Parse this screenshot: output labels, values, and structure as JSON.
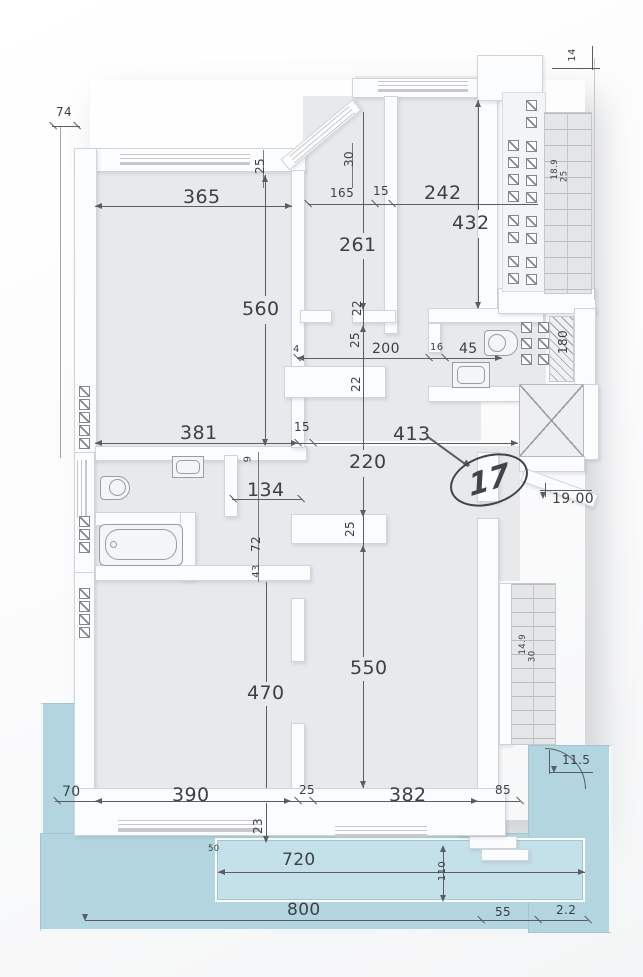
{
  "drawing": {
    "type": "apartment floor plan",
    "unit_number": "17"
  },
  "levels": {
    "main": "19.00",
    "terrace": "11.5"
  },
  "colors": {
    "floor": "#e7e9ea",
    "wall": "#fbfcfd",
    "wall_border": "#d2d5d8",
    "dimension_line": "#5a5e64",
    "text": "#3d4046",
    "terrace_blue": "#b2d5e0",
    "pool_blue": "#c4e0e9",
    "stairs_gray": "#e4e6e8"
  },
  "dimensions": {
    "top": {
      "d74": "74",
      "d365": "365",
      "d25": "25",
      "d30": "30",
      "d165": "165",
      "d15": "15",
      "d242": "242",
      "d432": "432",
      "d261": "261"
    },
    "middle": {
      "d22a": "22",
      "d25a": "25",
      "d4": "4",
      "d200": "200",
      "d16": "16",
      "d45": "45",
      "d180": "180",
      "d560": "560",
      "d381": "381",
      "d15b": "15",
      "d413": "413",
      "d220": "220",
      "d134": "134",
      "d9": "9",
      "d72": "72",
      "d43": "43",
      "d25b": "25"
    },
    "bottom": {
      "d470": "470",
      "d550": "550",
      "d70": "70",
      "d390": "390",
      "d25c": "25",
      "d382": "382",
      "d85": "85",
      "d23": "23",
      "d50": "50",
      "d720": "720",
      "d110": "110",
      "d800": "800",
      "d55": "55",
      "d2_2": "2.2"
    },
    "stairs": {
      "upper_a": "18.9",
      "upper_b": "25",
      "lower_a": "14.9",
      "lower_b": "30",
      "section_mark": "14"
    }
  },
  "icons": {
    "elevator": "elevator-x-icon",
    "toilet": "toilet-icon",
    "washbasin": "washbasin-icon",
    "bathtub": "bathtub-icon",
    "glass_block": "glass-block-icon",
    "stairs": "stairs-icon",
    "gate_arc": "door-swing-arc-icon",
    "level_marker": "level-marker-icon"
  }
}
